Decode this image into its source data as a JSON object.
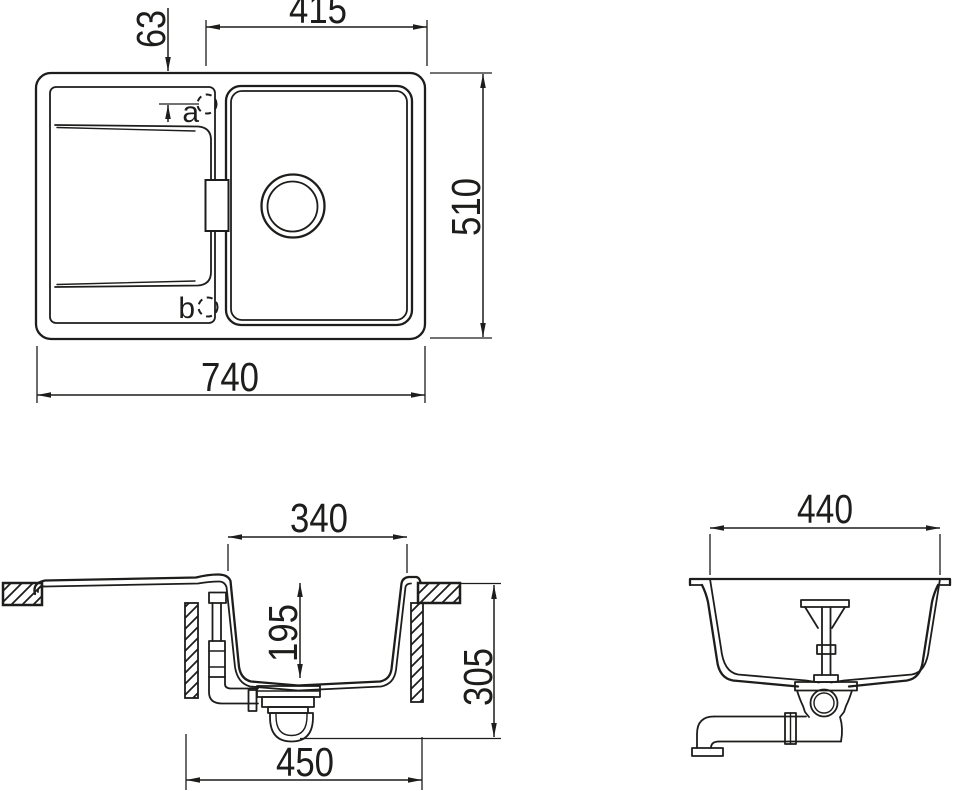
{
  "document": {
    "type": "sink-installation-drawing",
    "background": "#ffffff",
    "line_color": "#1d1d1b"
  },
  "views": {
    "top": {
      "name": "top view",
      "dims": {
        "overall_width": "740",
        "overall_depth": "510",
        "bowl_to_edge": "415",
        "hole_inset": "63"
      },
      "holes": {
        "a": "a",
        "b": "b"
      }
    },
    "side": {
      "name": "side section view",
      "dims": {
        "bowl_width": "340",
        "bowl_depth": "195",
        "overall_height": "305",
        "cabinet_width": "450"
      }
    },
    "front": {
      "name": "front section view",
      "dims": {
        "bowl_width": "440"
      }
    }
  }
}
